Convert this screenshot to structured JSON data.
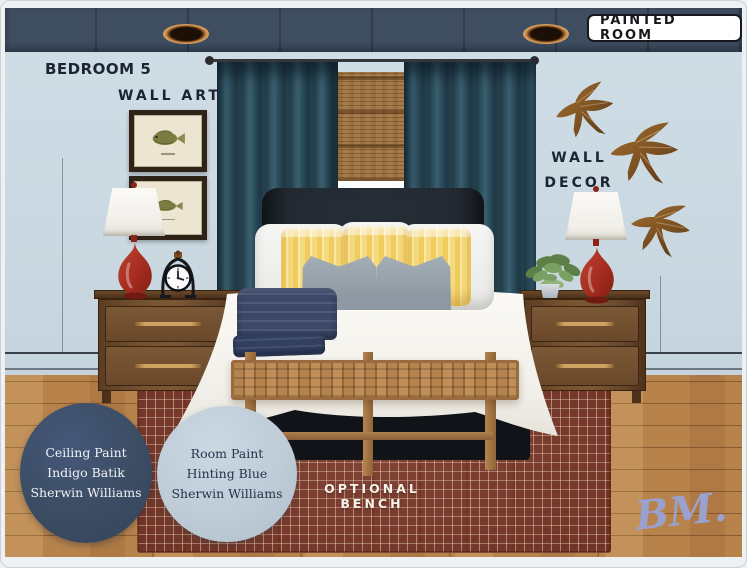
{
  "board": {
    "badge_label": "PAINTED ROOM",
    "room_label": "BEDROOM 5",
    "wall_art_label": "WALL ART",
    "wall_decor_line1": "WALL",
    "wall_decor_line2": "DECOR",
    "optional_bench_label": "OPTIONAL BENCH",
    "logo_text": "BM."
  },
  "paint_swatches": [
    {
      "id": "ceiling-paint",
      "lines": [
        "Ceiling Paint",
        "Indigo Batik",
        "Sherwin Williams"
      ],
      "swatch_hex": "#3b4c63",
      "text_hex": "#eef2f5"
    },
    {
      "id": "room-paint",
      "lines": [
        "Room Paint",
        "Hinting Blue",
        "Sherwin Williams"
      ],
      "swatch_hex": "#bfccd7",
      "text_hex": "#22344c"
    }
  ],
  "icons": {
    "recessed_light": "recessed-light",
    "swallow_decal": "woven-swallow-bird",
    "fish_print": "framed-fish-print",
    "alarm_clock": "arched-alarm-clock",
    "potted_plant": "trailing-potted-plant"
  },
  "palette": {
    "ceiling_band": "#3e4d60",
    "wall": "#cbd9e2",
    "curtain_teal": "#2c4856",
    "headboard": "#20252c",
    "pillow_yellow": "#f4d368",
    "lamp_red": "#a03227",
    "rug_rust": "#7b392a",
    "floor_oak": "#b8834b",
    "logo_lavender": "#9aa1cf"
  }
}
